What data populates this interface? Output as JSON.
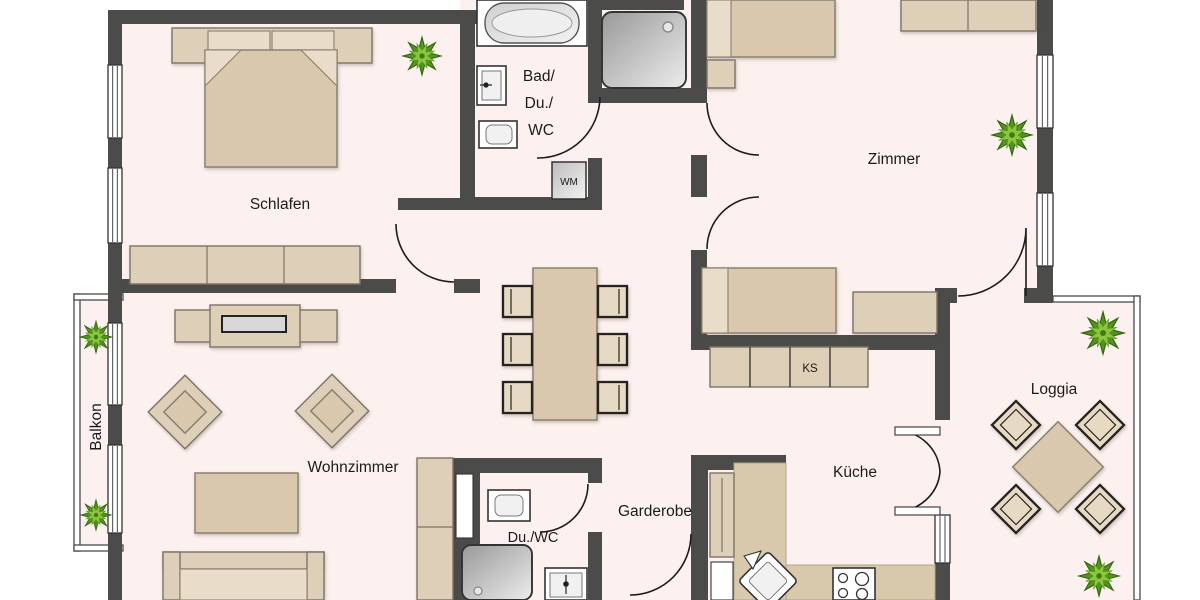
{
  "rooms": {
    "schlafen": "Schlafen",
    "bad_line1": "Bad/",
    "bad_line2": "Du./",
    "bad_line3": "WC",
    "zimmer": "Zimmer",
    "wohnzimmer": "Wohnzimmer",
    "balkon": "Balkon",
    "loggia": "Loggia",
    "kueche": "Küche",
    "garderobe": "Garderobe",
    "du_wc": "Du./WC"
  },
  "appliances": {
    "washing_machine": "WM",
    "refrigerator": "KS"
  },
  "colors": {
    "wall": "#4b4b49",
    "floor": "#fcf1ef",
    "furniture": "#ddcfb8",
    "furniture_dark": "#d9c8ae",
    "plant_dark": "#55931f",
    "plant_light": "#8cc63f",
    "text": "#1b1b1b"
  }
}
